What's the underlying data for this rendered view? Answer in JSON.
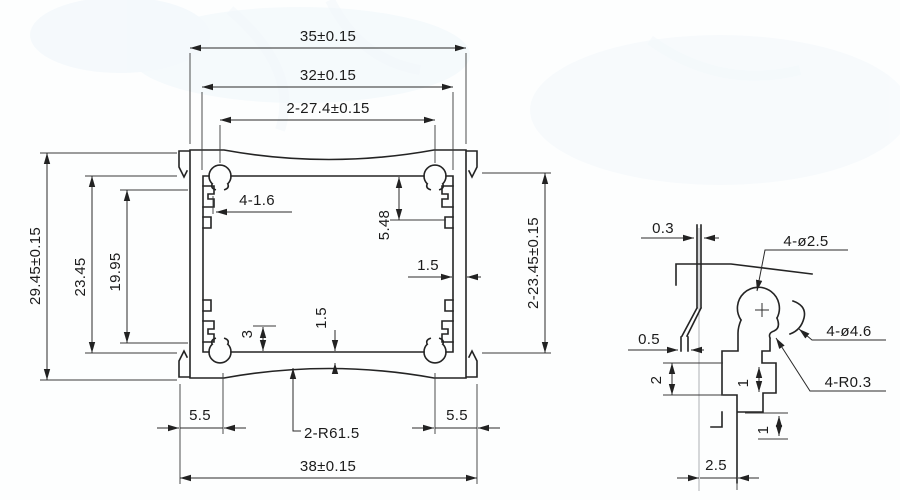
{
  "page": {
    "background": "#fdfefe",
    "line_color": "#242424",
    "watermark_color": "#e3eef7"
  },
  "main_view": {
    "labels": {
      "dim_35": "35±0.15",
      "dim_32": "32±0.15",
      "dim_27_4": "2-27.4±0.15",
      "dim_29_45": "29.45±0.15",
      "dim_23_45": "23.45",
      "dim_19_95": "19.95",
      "dim_2_23_45": "2-23.45±0.15",
      "dim_4_1_6": "4-1.6",
      "dim_5_48": "5.48",
      "dim_1_5_side": "1.5",
      "dim_3": "3",
      "dim_1_5_bottom": "1.5",
      "dim_5_5_left": "5.5",
      "dim_5_5_right": "5.5",
      "dim_2_r61_5": "2-R61.5",
      "dim_38": "38±0.15"
    }
  },
  "detail_view": {
    "labels": {
      "det_0_3": "0.3",
      "det_0_5": "0.5",
      "det_2": "2",
      "det_1_upper": "1",
      "det_1_lower": "1",
      "det_2_5": "2.5",
      "det_4_dia_2_5": "4-ø2.5",
      "det_4_dia_4_6": "4-ø4.6",
      "det_4_r_0_3": "4-R0.3"
    }
  }
}
